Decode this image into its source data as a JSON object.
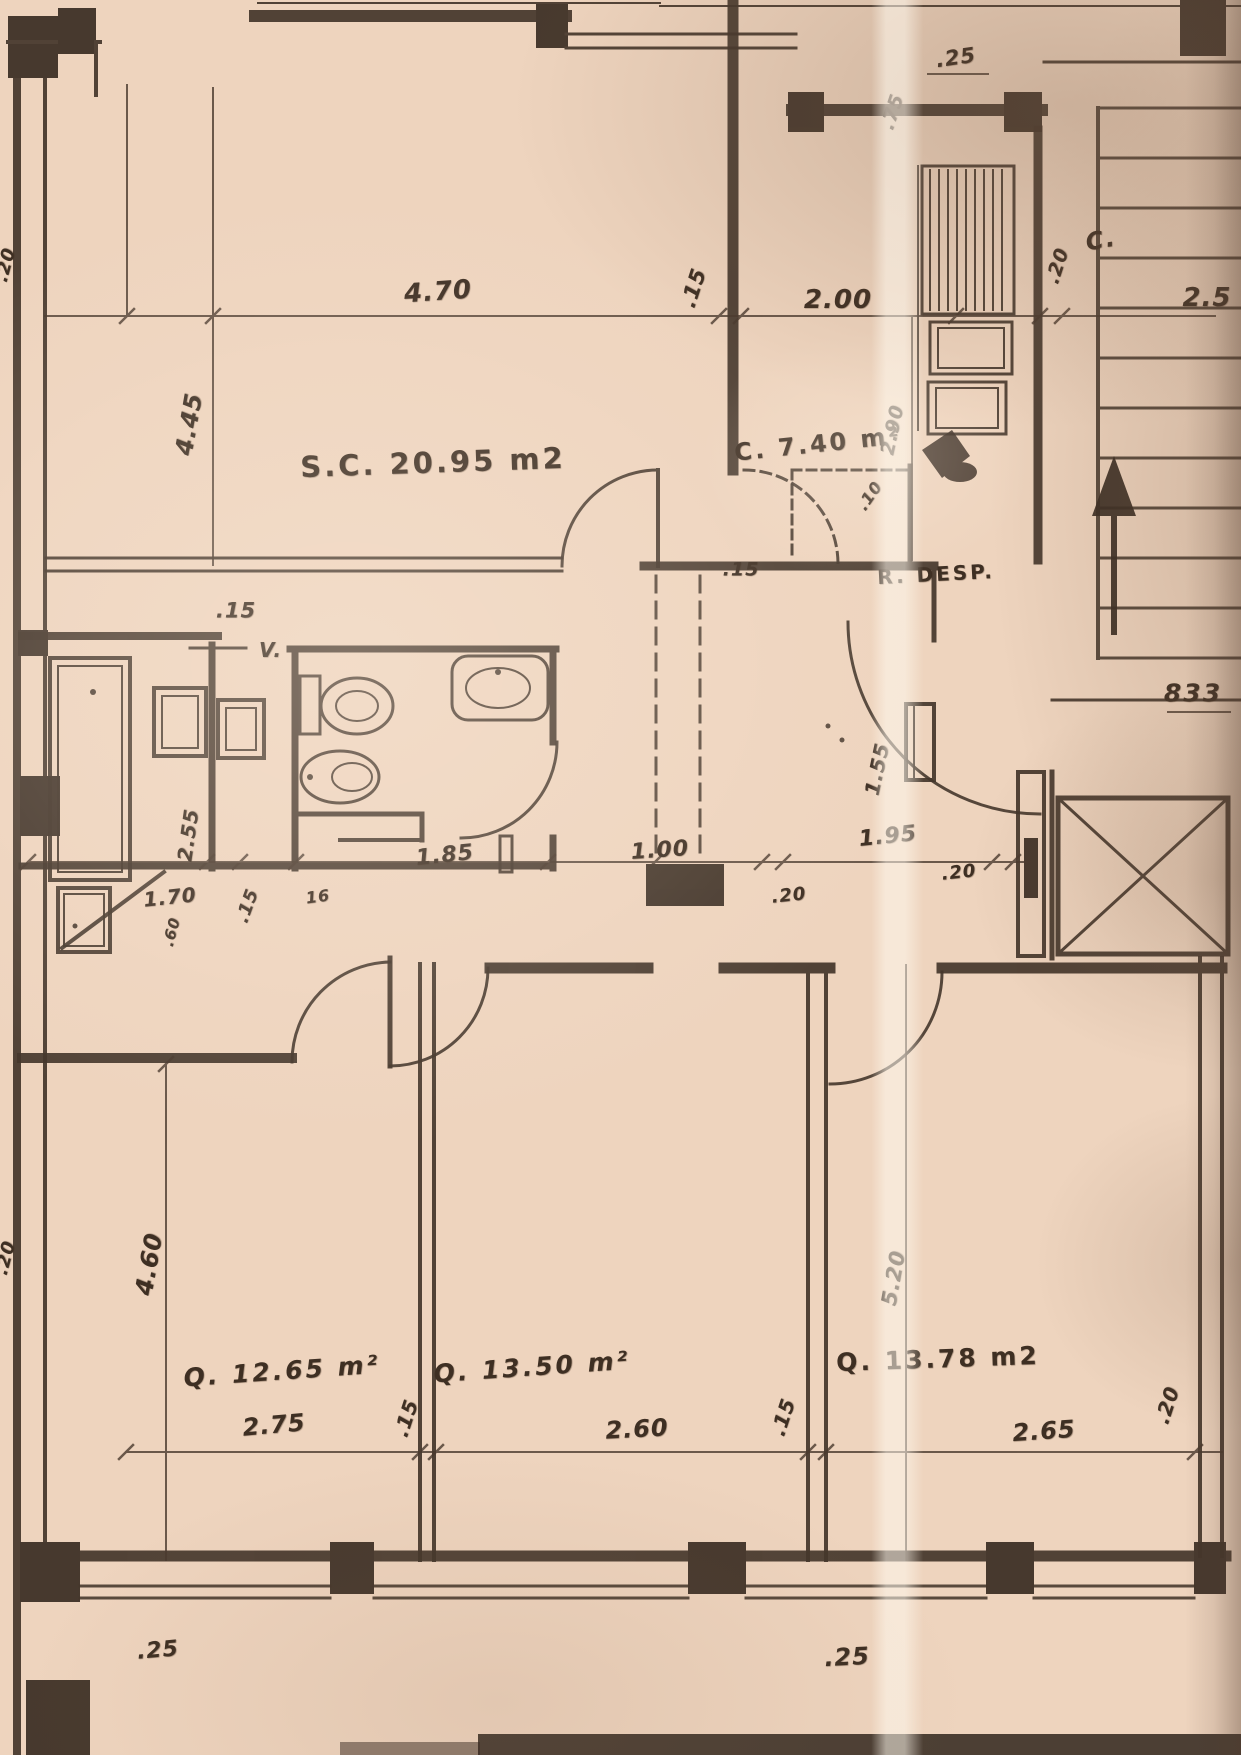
{
  "meta": {
    "description": "Scanned architectural floor plan of an apartment (old sepia blueprint)",
    "sheet_note": "833"
  },
  "colors": {
    "paper": "#eed4be",
    "ink": "#44362b",
    "dark_band": "#2f241c"
  },
  "rooms": [
    {
      "name": "living-dining",
      "code": "S.C.",
      "area_m2": "20.95",
      "label": "S.C. 20.95 m2"
    },
    {
      "name": "kitchen",
      "code": "C.",
      "area_m2": "7.40",
      "label": "C. 7.40 m²"
    },
    {
      "name": "pantry",
      "code": "R. DESP.",
      "area_m2": "",
      "label": "R. DESP."
    },
    {
      "name": "closet-landing",
      "code": "C.",
      "area_m2": "",
      "label": "C."
    },
    {
      "name": "bedroom-1",
      "code": "Q.",
      "area_m2": "12.65",
      "label": "Q. 12.65 m²"
    },
    {
      "name": "bedroom-2",
      "code": "Q.",
      "area_m2": "13.50",
      "label": "Q. 13.50 m²"
    },
    {
      "name": "bedroom-3",
      "code": "Q.",
      "area_m2": "13.78",
      "label": "Q. 13.78 m2"
    }
  ],
  "labels": [
    {
      "name": "dim-top-25",
      "text": ".25",
      "x": 956,
      "y": 58,
      "rot": -8,
      "size": 21,
      "kind": "dim"
    },
    {
      "name": "dim-top-75",
      "text": ".75",
      "x": 893,
      "y": 112,
      "rot": -72,
      "size": 19,
      "kind": "dim"
    },
    {
      "name": "dim-470",
      "text": "4.70",
      "x": 438,
      "y": 292,
      "rot": -4,
      "size": 26,
      "kind": "dim"
    },
    {
      "name": "dim-15-top-wall",
      "text": ".15",
      "x": 694,
      "y": 288,
      "rot": -72,
      "size": 21,
      "kind": "dim"
    },
    {
      "name": "dim-200",
      "text": "2.00",
      "x": 838,
      "y": 300,
      "rot": 0,
      "size": 26,
      "kind": "dim"
    },
    {
      "name": "dim-20-kitchen",
      "text": ".20",
      "x": 1058,
      "y": 266,
      "rot": -72,
      "size": 19,
      "kind": "dim"
    },
    {
      "name": "closet-label",
      "text": "C.",
      "x": 1101,
      "y": 240,
      "rot": -10,
      "size": 24,
      "kind": "note"
    },
    {
      "name": "dim-25-clipped",
      "text": "2.5",
      "x": 1207,
      "y": 298,
      "rot": 0,
      "size": 26,
      "kind": "dim"
    },
    {
      "name": "dim-445",
      "text": "4.45",
      "x": 189,
      "y": 424,
      "rot": -80,
      "size": 24,
      "kind": "dim"
    },
    {
      "name": "dim-290",
      "text": "2.90",
      "x": 893,
      "y": 430,
      "rot": -78,
      "size": 19,
      "kind": "dim"
    },
    {
      "name": "living-label",
      "text": "S.C. 20.95 m2",
      "x": 433,
      "y": 463,
      "rot": -2,
      "size": 29,
      "kind": "room"
    },
    {
      "name": "kitchen-label",
      "text": "C. 7.40 m²",
      "x": 818,
      "y": 444,
      "rot": -6,
      "size": 24,
      "kind": "room"
    },
    {
      "name": "dim-10",
      "text": ".10",
      "x": 870,
      "y": 496,
      "rot": -55,
      "size": 16,
      "kind": "dim"
    },
    {
      "name": "pantry-label",
      "text": "R. DESP.",
      "x": 936,
      "y": 574,
      "rot": -3,
      "size": 20,
      "kind": "room"
    },
    {
      "name": "dim-15-hall",
      "text": ".15",
      "x": 741,
      "y": 570,
      "rot": 0,
      "size": 19,
      "kind": "dim"
    },
    {
      "name": "sheet-number",
      "text": "833",
      "x": 1193,
      "y": 693,
      "rot": 0,
      "size": 25,
      "kind": "note"
    },
    {
      "name": "dim-155",
      "text": "1.55",
      "x": 877,
      "y": 769,
      "rot": -78,
      "size": 20,
      "kind": "dim"
    },
    {
      "name": "dim-15-bath",
      "text": ".15",
      "x": 236,
      "y": 611,
      "rot": 0,
      "size": 21,
      "kind": "dim"
    },
    {
      "name": "vent-label",
      "text": "V.",
      "x": 271,
      "y": 650,
      "rot": 0,
      "size": 20,
      "kind": "note"
    },
    {
      "name": "dim-255",
      "text": "2.55",
      "x": 188,
      "y": 835,
      "rot": -82,
      "size": 20,
      "kind": "dim"
    },
    {
      "name": "dim-170",
      "text": "1.70",
      "x": 170,
      "y": 897,
      "rot": -6,
      "size": 20,
      "kind": "dim"
    },
    {
      "name": "dim-15-mid",
      "text": ".15",
      "x": 248,
      "y": 906,
      "rot": -70,
      "size": 18,
      "kind": "dim"
    },
    {
      "name": "dim-16",
      "text": "16",
      "x": 318,
      "y": 897,
      "rot": -8,
      "size": 16,
      "kind": "dim"
    },
    {
      "name": "dim-185",
      "text": "1.85",
      "x": 445,
      "y": 856,
      "rot": -6,
      "size": 22,
      "kind": "dim"
    },
    {
      "name": "dim-100",
      "text": "1.00",
      "x": 660,
      "y": 851,
      "rot": -4,
      "size": 22,
      "kind": "dim"
    },
    {
      "name": "dim-20-a",
      "text": ".20",
      "x": 789,
      "y": 896,
      "rot": -6,
      "size": 18,
      "kind": "dim"
    },
    {
      "name": "dim-195",
      "text": "1.95",
      "x": 888,
      "y": 837,
      "rot": -6,
      "size": 22,
      "kind": "dim"
    },
    {
      "name": "dim-20-b",
      "text": ".20",
      "x": 959,
      "y": 873,
      "rot": -6,
      "size": 18,
      "kind": "dim"
    },
    {
      "name": "dim-60",
      "text": ".60",
      "x": 172,
      "y": 932,
      "rot": -75,
      "size": 15,
      "kind": "dim"
    },
    {
      "name": "dim-460",
      "text": "4.60",
      "x": 149,
      "y": 1264,
      "rot": -80,
      "size": 24,
      "kind": "dim"
    },
    {
      "name": "dim-520",
      "text": "5.20",
      "x": 894,
      "y": 1278,
      "rot": -80,
      "size": 21,
      "kind": "dim"
    },
    {
      "name": "dim-275",
      "text": "2.75",
      "x": 274,
      "y": 1425,
      "rot": -5,
      "size": 24,
      "kind": "dim"
    },
    {
      "name": "dim-15-b1",
      "text": ".15",
      "x": 406,
      "y": 1418,
      "rot": -72,
      "size": 20,
      "kind": "dim"
    },
    {
      "name": "dim-260",
      "text": "2.60",
      "x": 637,
      "y": 1429,
      "rot": -3,
      "size": 24,
      "kind": "dim"
    },
    {
      "name": "dim-15-b2",
      "text": ".15",
      "x": 783,
      "y": 1417,
      "rot": -72,
      "size": 20,
      "kind": "dim"
    },
    {
      "name": "dim-265",
      "text": "2.65",
      "x": 1044,
      "y": 1431,
      "rot": -4,
      "size": 24,
      "kind": "dim"
    },
    {
      "name": "dim-20-b3",
      "text": ".20",
      "x": 1167,
      "y": 1405,
      "rot": -72,
      "size": 20,
      "kind": "dim"
    },
    {
      "name": "bedroom1-label",
      "text": "Q. 12.65 m²",
      "x": 282,
      "y": 1371,
      "rot": -4,
      "size": 25,
      "kind": "room dim"
    },
    {
      "name": "bedroom2-label",
      "text": "Q. 13.50 m²",
      "x": 532,
      "y": 1367,
      "rot": -4,
      "size": 25,
      "kind": "room dim"
    },
    {
      "name": "bedroom3-label",
      "text": "Q. 13.78 m2",
      "x": 938,
      "y": 1359,
      "rot": -2,
      "size": 25,
      "kind": "room"
    },
    {
      "name": "dim-25-bottom-left",
      "text": ".25",
      "x": 158,
      "y": 1651,
      "rot": -5,
      "size": 22,
      "kind": "dim"
    },
    {
      "name": "dim-25-bottom-right",
      "text": ".25",
      "x": 847,
      "y": 1657,
      "rot": -3,
      "size": 24,
      "kind": "dim"
    },
    {
      "name": "dim-20-left-top",
      "text": ".20",
      "x": 6,
      "y": 265,
      "rot": -75,
      "size": 18,
      "kind": "dim"
    },
    {
      "name": "dim-20-left-mid",
      "text": ".20",
      "x": 6,
      "y": 1258,
      "rot": -75,
      "size": 18,
      "kind": "dim"
    }
  ]
}
